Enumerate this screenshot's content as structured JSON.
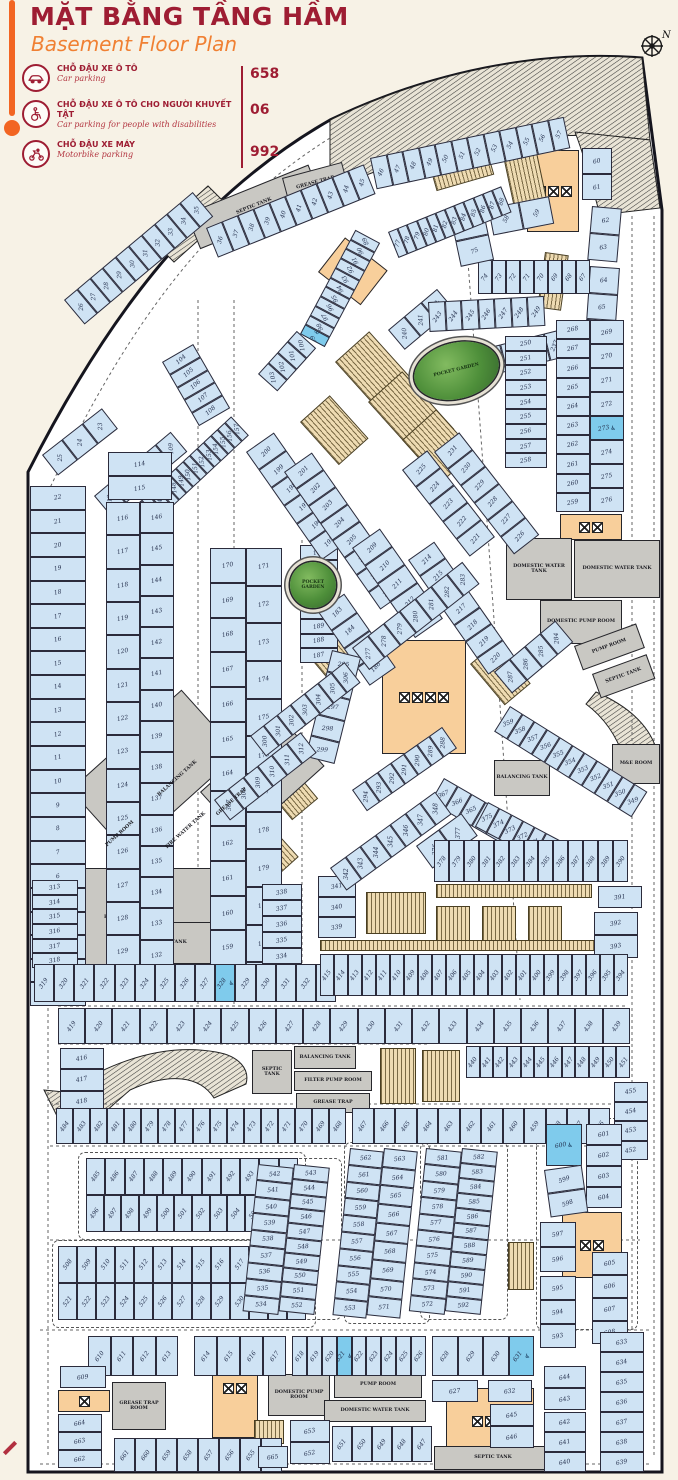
{
  "header": {
    "title": "MẶT BẰNG TẦNG HẦM",
    "subtitle": "Basement Floor Plan"
  },
  "legend": {
    "items": [
      {
        "id": "car",
        "icon": "car-icon",
        "label_vi": "CHỖ ĐẬU XE Ô TÔ",
        "label_en": "Car parking",
        "count": "658"
      },
      {
        "id": "disabled",
        "icon": "wheelchair-icon",
        "label_vi": "CHỖ ĐẬU XE Ô TÔ CHO NGƯỜI KHUYẾT TẬT",
        "label_en": "Car parking for people with disabilities",
        "count": "06"
      },
      {
        "id": "motorbike",
        "icon": "motorbike-icon",
        "label_vi": "CHỖ ĐẬU XE MÁY",
        "label_en": "Motorbike parking",
        "count": "992"
      }
    ]
  },
  "compass": {
    "label": "N"
  },
  "colors": {
    "accent_orange": "#f26522",
    "title_red": "#9e1d33",
    "stall_blue": "#cfe3f4",
    "disabled_blue": "#7fcbec",
    "moto_tan": "#eedbb2",
    "room_gray": "#c9c8c3",
    "core_orange": "#f8cf9b",
    "garden_green": "#4e8f3a",
    "paper_cream": "#f7f2e6"
  },
  "plan": {
    "garden_label": "POCKET GARDEN",
    "disabled_stalls": [
      99,
      273,
      328,
      600,
      621,
      631
    ],
    "zones": [
      {
        "id": "z1_22",
        "type": "car",
        "from": 1,
        "to": 22,
        "order": "desc"
      },
      {
        "id": "z23_25",
        "type": "car",
        "from": 23,
        "to": 25,
        "order": "desc"
      },
      {
        "id": "z26_35",
        "type": "car",
        "from": 26,
        "to": 35
      },
      {
        "id": "z36_45",
        "type": "car",
        "from": 36,
        "to": 45
      },
      {
        "id": "z46_57",
        "type": "car",
        "from": 46,
        "to": 57
      },
      {
        "id": "z58_59",
        "type": "car",
        "from": 58,
        "to": 59
      },
      {
        "id": "z60_61",
        "type": "car",
        "from": 60,
        "to": 61
      },
      {
        "id": "z62_63",
        "type": "car",
        "from": 62,
        "to": 63
      },
      {
        "id": "z64_66",
        "type": "car",
        "from": 64,
        "to": 66
      },
      {
        "id": "z67_74",
        "type": "car",
        "from": 67,
        "to": 74,
        "order": "desc"
      },
      {
        "id": "z75_76",
        "type": "car",
        "from": 75,
        "to": 76,
        "order": "desc"
      },
      {
        "id": "z77_88",
        "type": "car",
        "from": 77,
        "to": 88
      },
      {
        "id": "z89_99",
        "type": "car",
        "from": 89,
        "to": 99,
        "order": "desc",
        "disabled": [
          99
        ]
      },
      {
        "id": "z100_103",
        "type": "car",
        "from": 100,
        "to": 103,
        "order": "desc"
      },
      {
        "id": "z104_108",
        "type": "car",
        "from": 104,
        "to": 108
      },
      {
        "id": "z109_113",
        "type": "car",
        "from": 109,
        "to": 113,
        "order": "desc"
      },
      {
        "id": "z114_115",
        "type": "car",
        "from": 114,
        "to": 115
      },
      {
        "id": "z116_130",
        "type": "car",
        "from": 116,
        "to": 130
      },
      {
        "id": "z131_146",
        "type": "car",
        "from": 131,
        "to": 146,
        "order": "desc"
      },
      {
        "id": "z142_157",
        "type": "car",
        "from": 142,
        "to": 157
      },
      {
        "id": "z158_170",
        "type": "car",
        "from": 158,
        "to": 170,
        "order": "desc"
      },
      {
        "id": "z171_182",
        "type": "car",
        "from": 171,
        "to": 182
      },
      {
        "id": "z183_186",
        "type": "car",
        "from": 183,
        "to": 186
      },
      {
        "id": "z187_194",
        "type": "car",
        "from": 187,
        "to": 194,
        "order": "desc"
      },
      {
        "id": "z195_200",
        "type": "car",
        "from": 195,
        "to": 200,
        "order": "desc"
      },
      {
        "id": "z201_208",
        "type": "car",
        "from": 201,
        "to": 208
      },
      {
        "id": "z209_213",
        "type": "car",
        "from": 209,
        "to": 213
      },
      {
        "id": "z214_220",
        "type": "car",
        "from": 214,
        "to": 220
      },
      {
        "id": "z221_225",
        "type": "car",
        "from": 221,
        "to": 225,
        "order": "desc"
      },
      {
        "id": "z226_231",
        "type": "car",
        "from": 226,
        "to": 231,
        "order": "desc"
      },
      {
        "id": "z232_239",
        "type": "car",
        "from": 232,
        "to": 239
      },
      {
        "id": "z240_242",
        "type": "car",
        "from": 240,
        "to": 242
      },
      {
        "id": "z243_249",
        "type": "car",
        "from": 243,
        "to": 249
      },
      {
        "id": "z250_258",
        "type": "car",
        "from": 250,
        "to": 258
      },
      {
        "id": "z259_268",
        "type": "car",
        "from": 259,
        "to": 268,
        "order": "desc"
      },
      {
        "id": "z269_276",
        "type": "car",
        "from": 269,
        "to": 276,
        "disabled": [
          273
        ]
      },
      {
        "id": "z277_283",
        "type": "car",
        "from": 277,
        "to": 283
      },
      {
        "id": "z284_287",
        "type": "car",
        "from": 284,
        "to": 287,
        "order": "desc"
      },
      {
        "id": "z288_294",
        "type": "car",
        "from": 288,
        "to": 294,
        "order": "desc"
      },
      {
        "id": "z295_299",
        "type": "car",
        "from": 295,
        "to": 299
      },
      {
        "id": "z300_306",
        "type": "car",
        "from": 300,
        "to": 306
      },
      {
        "id": "z307_312",
        "type": "car",
        "from": 307,
        "to": 312
      },
      {
        "id": "z313_318",
        "type": "car",
        "from": 313,
        "to": 318
      },
      {
        "id": "z319_333",
        "type": "car",
        "from": 319,
        "to": 333,
        "disabled": [
          328
        ]
      },
      {
        "id": "z334_338",
        "type": "car",
        "from": 334,
        "to": 338,
        "order": "desc"
      },
      {
        "id": "z339_341",
        "type": "car",
        "from": 339,
        "to": 341,
        "order": "desc"
      },
      {
        "id": "z342_348",
        "type": "car",
        "from": 342,
        "to": 348
      },
      {
        "id": "z349_359",
        "type": "car",
        "from": 349,
        "to": 359,
        "order": "desc"
      },
      {
        "id": "z360_367",
        "type": "car",
        "from": 360,
        "to": 367,
        "order": "desc"
      },
      {
        "id": "z368_375",
        "type": "car",
        "from": 368,
        "to": 375,
        "order": "desc"
      },
      {
        "id": "z376_377",
        "type": "car",
        "from": 376,
        "to": 377
      },
      {
        "id": "z378_390",
        "type": "car",
        "from": 378,
        "to": 390
      },
      {
        "id": "z391",
        "type": "car",
        "from": 391,
        "to": 391
      },
      {
        "id": "z392_393",
        "type": "car",
        "from": 392,
        "to": 393
      },
      {
        "id": "z394_415",
        "type": "car",
        "from": 394,
        "to": 415,
        "order": "desc"
      },
      {
        "id": "z416_418",
        "type": "car",
        "from": 416,
        "to": 418
      },
      {
        "id": "z419_439",
        "type": "car",
        "from": 419,
        "to": 439
      },
      {
        "id": "z440_451",
        "type": "car",
        "from": 440,
        "to": 451
      },
      {
        "id": "z452_455",
        "type": "car",
        "from": 452,
        "to": 455,
        "order": "desc"
      },
      {
        "id": "z456_467",
        "type": "car",
        "from": 456,
        "to": 467,
        "order": "desc"
      },
      {
        "id": "z468_484",
        "type": "car",
        "from": 468,
        "to": 484,
        "order": "desc"
      },
      {
        "id": "z485_495",
        "type": "car",
        "from": 485,
        "to": 495
      },
      {
        "id": "z496_507",
        "type": "car",
        "from": 496,
        "to": 507
      },
      {
        "id": "z508_520",
        "type": "car",
        "from": 508,
        "to": 520
      },
      {
        "id": "z521_533",
        "type": "car",
        "from": 521,
        "to": 533
      },
      {
        "id": "z534_542",
        "type": "car",
        "from": 534,
        "to": 542,
        "order": "desc"
      },
      {
        "id": "z543_552",
        "type": "car",
        "from": 543,
        "to": 552
      },
      {
        "id": "z553_562",
        "type": "car",
        "from": 553,
        "to": 562,
        "order": "desc"
      },
      {
        "id": "z563_571",
        "type": "car",
        "from": 563,
        "to": 571
      },
      {
        "id": "z572_581",
        "type": "car",
        "from": 572,
        "to": 581,
        "order": "desc"
      },
      {
        "id": "z582_592",
        "type": "car",
        "from": 582,
        "to": 592
      },
      {
        "id": "z593_595",
        "type": "car",
        "from": 593,
        "to": 595,
        "order": "desc"
      },
      {
        "id": "z596_597",
        "type": "car",
        "from": 596,
        "to": 597,
        "order": "desc"
      },
      {
        "id": "z598_599",
        "type": "car",
        "from": 598,
        "to": 599,
        "order": "desc"
      },
      {
        "id": "z600",
        "type": "car",
        "from": 600,
        "to": 600,
        "disabled": [
          600
        ]
      },
      {
        "id": "z601_604",
        "type": "car",
        "from": 601,
        "to": 604
      },
      {
        "id": "z605_608",
        "type": "car",
        "from": 605,
        "to": 608
      },
      {
        "id": "z609",
        "type": "car",
        "from": 609,
        "to": 609
      },
      {
        "id": "z610_613",
        "type": "car",
        "from": 610,
        "to": 613
      },
      {
        "id": "z614_617",
        "type": "car",
        "from": 614,
        "to": 617
      },
      {
        "id": "z618_626",
        "type": "car",
        "from": 618,
        "to": 626,
        "disabled": [
          621
        ]
      },
      {
        "id": "z627",
        "type": "car",
        "from": 627,
        "to": 627
      },
      {
        "id": "z628_631",
        "type": "car",
        "from": 628,
        "to": 631,
        "disabled": [
          631
        ]
      },
      {
        "id": "z632",
        "type": "car",
        "from": 632,
        "to": 632
      },
      {
        "id": "z633_639",
        "type": "car",
        "from": 633,
        "to": 639
      },
      {
        "id": "z640_642",
        "type": "car",
        "from": 640,
        "to": 642,
        "order": "desc"
      },
      {
        "id": "z643_644",
        "type": "car",
        "from": 643,
        "to": 644,
        "order": "desc"
      },
      {
        "id": "z645_646",
        "type": "car",
        "from": 645,
        "to": 646
      },
      {
        "id": "z647_651",
        "type": "car",
        "from": 647,
        "to": 651,
        "order": "desc"
      },
      {
        "id": "z652_653",
        "type": "car",
        "from": 652,
        "to": 653,
        "order": "desc"
      },
      {
        "id": "z654_661",
        "type": "car",
        "from": 654,
        "to": 661,
        "order": "desc"
      },
      {
        "id": "z662_664",
        "type": "car",
        "from": 662,
        "to": 664,
        "order": "desc"
      },
      {
        "id": "z665",
        "type": "car",
        "from": 665,
        "to": 665
      },
      {
        "id": "rsep1",
        "type": "room",
        "label": "SEPTIC TANK"
      },
      {
        "id": "rgr1",
        "type": "room",
        "label": "GREASE TRAP"
      },
      {
        "id": "rdwt1",
        "type": "room",
        "label": "DOMESTIC WATER TANK"
      },
      {
        "id": "rdwt2",
        "type": "room",
        "label": "DOMESTIC WATER TANK"
      },
      {
        "id": "rdpr",
        "type": "room",
        "label": "DOMESTIC PUMP ROOM"
      },
      {
        "id": "rprr",
        "type": "room",
        "label": "PUMP ROOM"
      },
      {
        "id": "rstr",
        "type": "room",
        "label": "SEPTIC TANK"
      },
      {
        "id": "rme",
        "type": "room",
        "label": "M&E ROOM"
      },
      {
        "id": "rpbt",
        "type": "room",
        "label": "BALANCING TANK"
      },
      {
        "id": "rg1",
        "type": "room",
        "label": "FIRE WATER TANK"
      },
      {
        "id": "rg4",
        "type": "room",
        "label": "SEPTIC TANK"
      },
      {
        "id": "lblpump",
        "type": "label",
        "label": "PUMP ROOM"
      },
      {
        "id": "lblfwt",
        "type": "label",
        "label": "FIRE WATER TANK"
      },
      {
        "id": "lblbt",
        "type": "label",
        "label": "BALANCING TANK"
      },
      {
        "id": "lblgt",
        "type": "label",
        "label": "GREASE TRAP"
      },
      {
        "id": "rst2",
        "type": "room",
        "label": "SEPTIC TANK"
      },
      {
        "id": "rbt2",
        "type": "room",
        "label": "BALANCING TANK"
      },
      {
        "id": "rfpr",
        "type": "room",
        "label": "FILTER PUMP ROOM"
      },
      {
        "id": "rgt2",
        "type": "room",
        "label": "GREASE TRAP"
      },
      {
        "id": "rgtr",
        "type": "room",
        "label": "GREASE TRAP ROOM"
      },
      {
        "id": "rdpr2",
        "type": "room",
        "label": "DOMESTIC PUMP ROOM"
      },
      {
        "id": "rpr2",
        "type": "room",
        "label": "PUMP ROOM"
      },
      {
        "id": "rdwt3",
        "type": "room",
        "label": "DOMESTIC WATER TANK"
      },
      {
        "id": "rstb",
        "type": "room",
        "label": "SEPTIC TANK"
      },
      {
        "id": "garden1",
        "type": "garden",
        "label": "POCKET GARDEN"
      },
      {
        "id": "garden2",
        "type": "garden",
        "label": "POCKET GARDEN"
      }
    ]
  }
}
